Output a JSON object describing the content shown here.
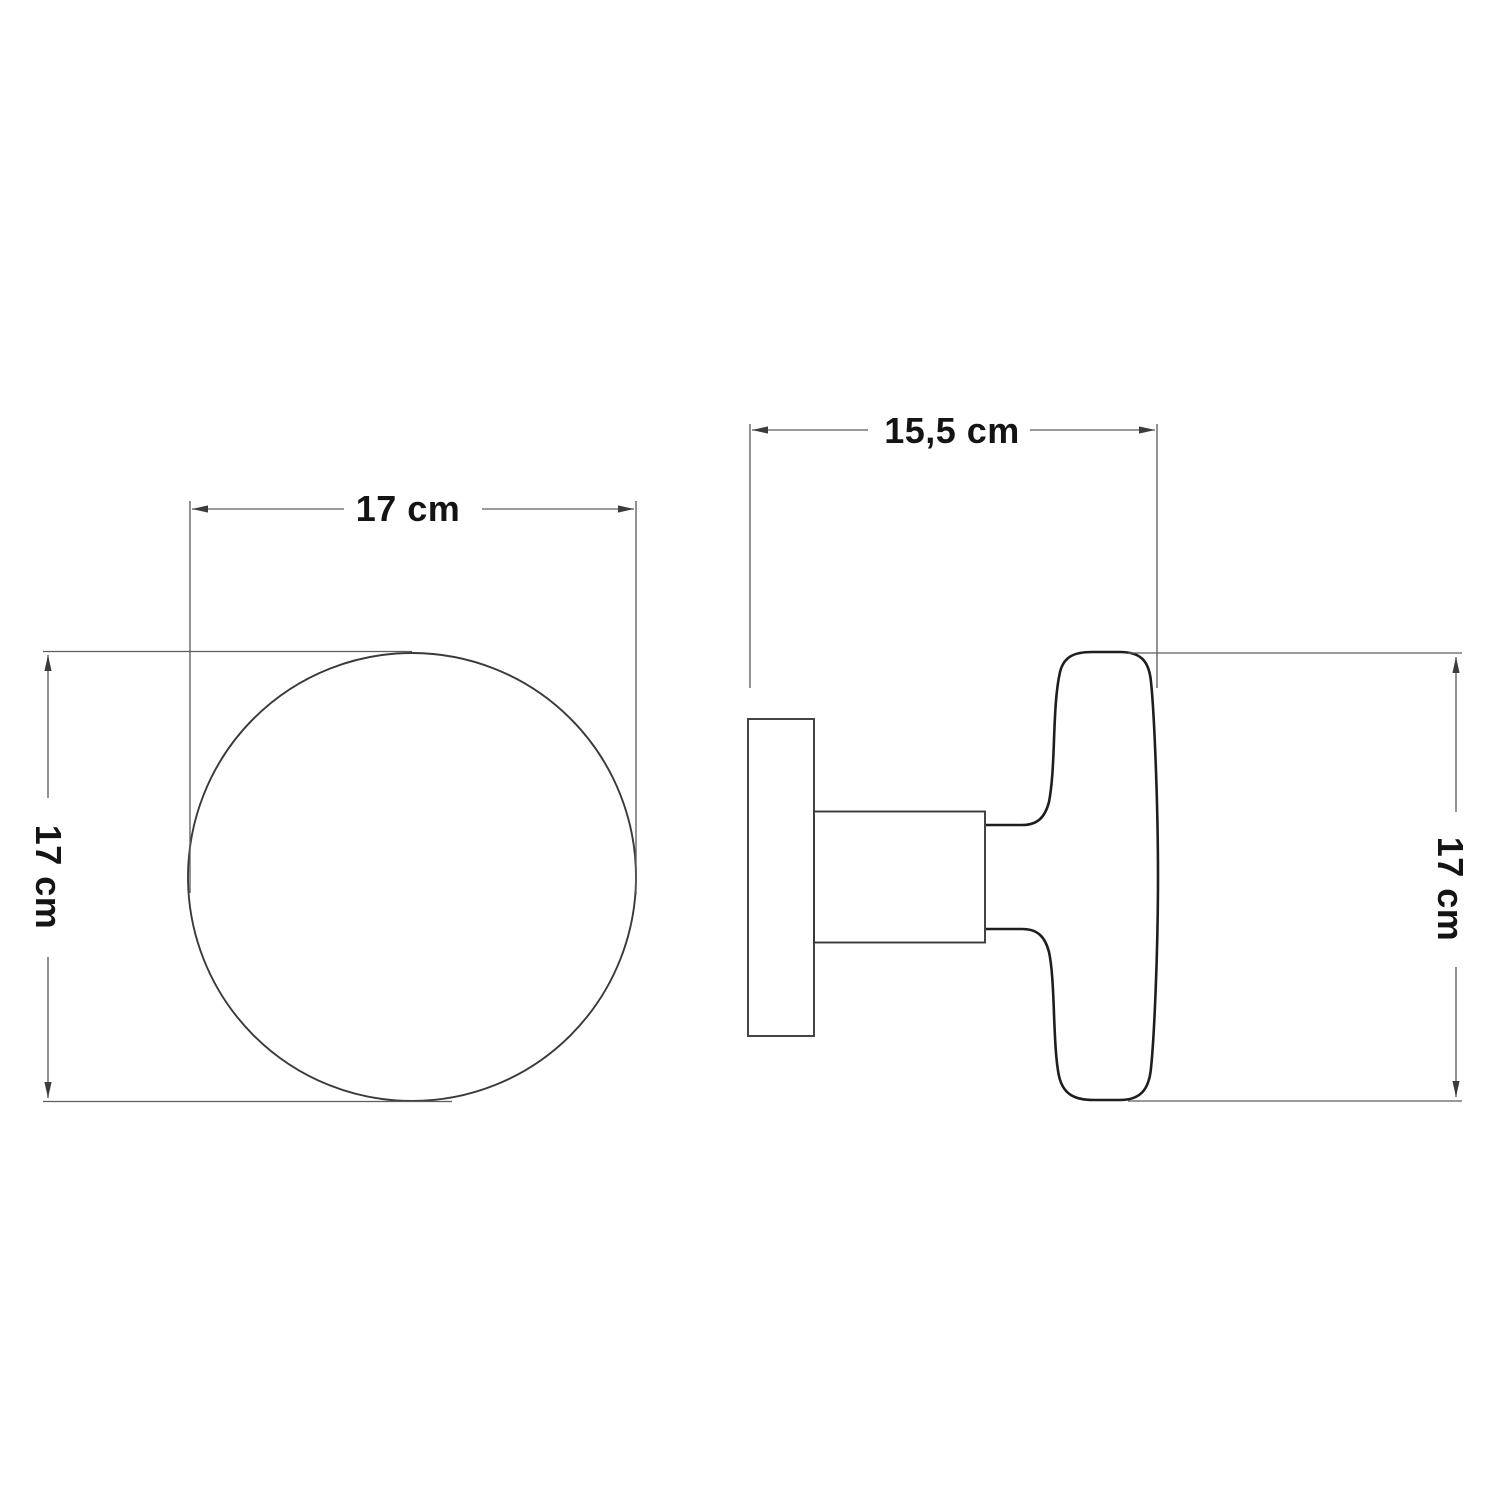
{
  "drawing": {
    "type": "technical-dimension-drawing",
    "views": {
      "front": {
        "width_label": "17 cm",
        "height_label": "17 cm"
      },
      "side": {
        "depth_label": "15,5 cm",
        "height_label": "17 cm"
      }
    },
    "colors": {
      "background": "#ffffff",
      "object_outline": "#1e1e1e",
      "secondary_outline": "#3a3a3a",
      "dimension_line": "#5d5d5d",
      "label_text": "#141414"
    }
  }
}
